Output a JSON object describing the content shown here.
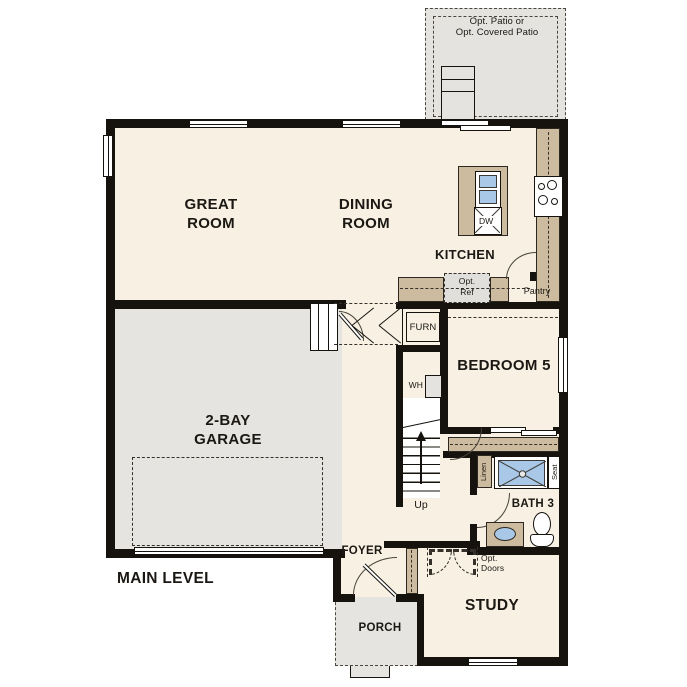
{
  "floor_plan": {
    "level_title": "MAIN LEVEL",
    "rooms": {
      "great_room": "GREAT\nROOM",
      "dining_room": "DINING\nROOM",
      "kitchen": "KITCHEN",
      "garage": "2-BAY\nGARAGE",
      "bedroom_5": "BEDROOM 5",
      "bath_3": "BATH 3",
      "study": "STUDY",
      "foyer": "FOYER",
      "porch": "PORCH"
    },
    "annotations": {
      "opt_patio": "Opt. Patio or\nOpt. Covered Patio",
      "opt_ref": "Opt.\nRef",
      "pantry": "Pantry",
      "furnace": "FURN",
      "water_heater": "WH",
      "stairs_direction": "Up",
      "linen": "Linen",
      "shower_seat": "Seat",
      "opt_doors": "Opt.\nDoors",
      "dishwasher": "DW"
    },
    "colors": {
      "floor": "#f7f0e3",
      "garage_floor": "#e5e4e0",
      "patio_floor": "#e4e3df",
      "counter": "#ccbb9e",
      "wall": "#16130e",
      "fixture_blue": "#a9c7e6"
    }
  }
}
